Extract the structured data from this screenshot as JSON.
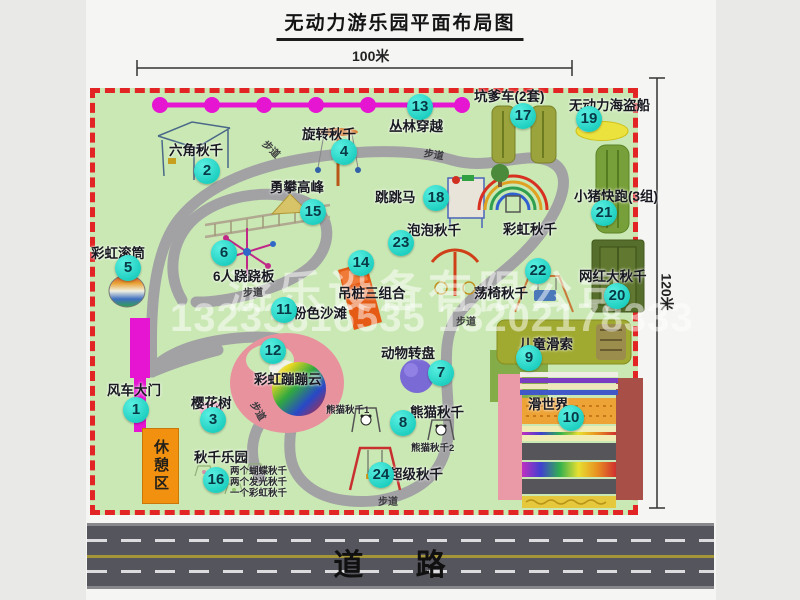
{
  "meta": {
    "title": "无动力游乐园平面布局图"
  },
  "dimensions": {
    "width_label": "100米",
    "height_label": "120米"
  },
  "road": {
    "label": "道  路"
  },
  "watermark": {
    "company": "游乐设备有限公司",
    "phones": "13233816535 13202178333"
  },
  "park": {
    "rest_area_label": "休憩区",
    "path_label": "步道",
    "extra_labels": [
      {
        "label": "彩虹秋千"
      }
    ],
    "attractions": [
      {
        "num": 1,
        "label": "风车大门"
      },
      {
        "num": 2,
        "label": "六角秋千"
      },
      {
        "num": 3,
        "label": "樱花树"
      },
      {
        "num": 4,
        "label": "旋转秋千"
      },
      {
        "num": 5,
        "label": "彩虹滚筒"
      },
      {
        "num": 6,
        "label": "6人跷跷板"
      },
      {
        "num": 7,
        "label": "动物转盘"
      },
      {
        "num": 8,
        "label": "熊猫秋千",
        "sublabels": [
          "熊猫秋千1",
          "熊猫秋千2"
        ]
      },
      {
        "num": 9,
        "label": "儿童滑索"
      },
      {
        "num": 10,
        "label": "滑世界"
      },
      {
        "num": 11,
        "label": "粉色沙滩"
      },
      {
        "num": 12,
        "label": "彩虹蹦蹦云"
      },
      {
        "num": 13,
        "label": "丛林穿越"
      },
      {
        "num": 14,
        "label": "吊桩三组合"
      },
      {
        "num": 15,
        "label": "勇攀高峰"
      },
      {
        "num": 16,
        "label": "秋千乐园",
        "sublabels": [
          "两个蝴蝶秋千",
          "两个发光秋千",
          "一个彩虹秋千"
        ]
      },
      {
        "num": 17,
        "label": "坑爹车(2套)"
      },
      {
        "num": 18,
        "label": "跳跳马"
      },
      {
        "num": 19,
        "label": "无动力海盗船"
      },
      {
        "num": 20,
        "label": "网红大秋千"
      },
      {
        "num": 21,
        "label": "小猪快跑(3组)"
      },
      {
        "num": 22,
        "label": "荡椅秋千"
      },
      {
        "num": 23,
        "label": "泡泡秋千"
      },
      {
        "num": 24,
        "label": "超级秋千"
      }
    ]
  },
  "colors": {
    "park_green": "#cae8b4",
    "border_red": "#e32424",
    "badge_teal": "#1ecfc0",
    "gate_magenta": "#e515d2",
    "road_gray": "#55555d"
  }
}
